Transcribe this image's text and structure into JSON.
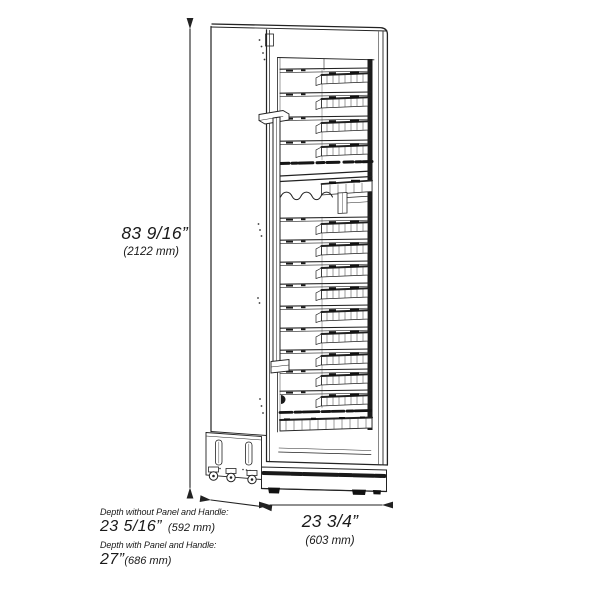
{
  "figure": {
    "subject": "Tall single-door wine cooler with glass door, interior shelves, compressor base and casters — front-left perspective line drawing",
    "shelf_count": 13
  },
  "dimensions": {
    "height": {
      "imperial": "83 9/16”",
      "metric": "(2122 mm)"
    },
    "width": {
      "imperial": "23 3/4”",
      "metric": "(603 mm)"
    },
    "depth_without_panel": {
      "label": "Depth without Panel and Handle:",
      "imperial": "23 5/16”",
      "metric": "(592 mm)"
    },
    "depth_with_panel": {
      "label": "Depth with Panel and Handle:",
      "imperial": "27”",
      "metric": "(686 mm)"
    }
  },
  "colors": {
    "line": "#222222",
    "background": "#ffffff"
  }
}
